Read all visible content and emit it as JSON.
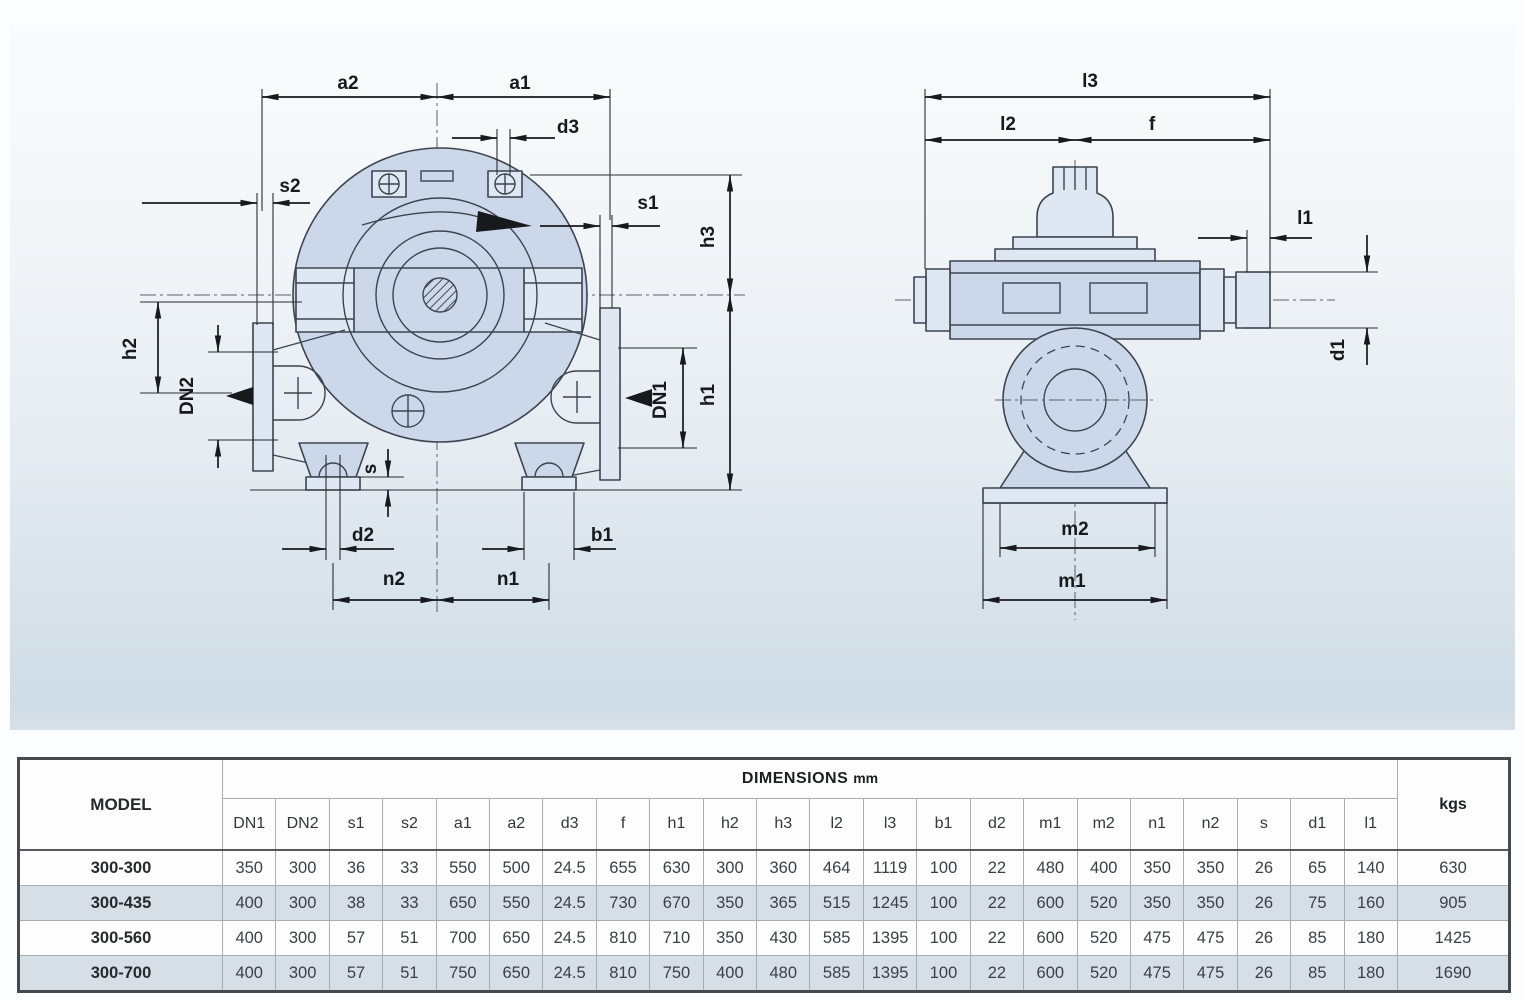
{
  "drawing": {
    "front_labels": {
      "a2": "a2",
      "a1": "a1",
      "d3": "d3",
      "s2": "s2",
      "s1": "s1",
      "h3": "h3",
      "h2": "h2",
      "h1": "h1",
      "dn2": "DN2",
      "dn1": "DN1",
      "s": "s",
      "d2": "d2",
      "b1": "b1",
      "n2": "n2",
      "n1": "n1"
    },
    "side_labels": {
      "l3": "l3",
      "l2": "l2",
      "f": "f",
      "l1": "l1",
      "d1": "d1",
      "m2": "m2",
      "m1": "m1"
    }
  },
  "table": {
    "model_header": "MODEL",
    "dimensions_header": "DIMENSIONS",
    "dimensions_unit": "mm",
    "weight_header": "kgs",
    "columns": [
      "DN1",
      "DN2",
      "s1",
      "s2",
      "a1",
      "a2",
      "d3",
      "f",
      "h1",
      "h2",
      "h3",
      "l2",
      "l3",
      "b1",
      "d2",
      "m1",
      "m2",
      "n1",
      "n2",
      "s",
      "d1",
      "l1"
    ],
    "rows": [
      {
        "model": "300-300",
        "values": [
          "350",
          "300",
          "36",
          "33",
          "550",
          "500",
          "24.5",
          "655",
          "630",
          "300",
          "360",
          "464",
          "1119",
          "100",
          "22",
          "480",
          "400",
          "350",
          "350",
          "26",
          "65",
          "140"
        ],
        "weight": "630"
      },
      {
        "model": "300-435",
        "values": [
          "400",
          "300",
          "38",
          "33",
          "650",
          "550",
          "24.5",
          "730",
          "670",
          "350",
          "365",
          "515",
          "1245",
          "100",
          "22",
          "600",
          "520",
          "350",
          "350",
          "26",
          "75",
          "160"
        ],
        "weight": "905"
      },
      {
        "model": "300-560",
        "values": [
          "400",
          "300",
          "57",
          "51",
          "700",
          "650",
          "24.5",
          "810",
          "710",
          "350",
          "430",
          "585",
          "1395",
          "100",
          "22",
          "600",
          "520",
          "475",
          "475",
          "26",
          "85",
          "180"
        ],
        "weight": "1425"
      },
      {
        "model": "300-700",
        "values": [
          "400",
          "300",
          "57",
          "51",
          "750",
          "650",
          "24.5",
          "810",
          "750",
          "400",
          "480",
          "585",
          "1395",
          "100",
          "22",
          "600",
          "520",
          "475",
          "475",
          "26",
          "85",
          "180"
        ],
        "weight": "1690"
      }
    ]
  },
  "colors": {
    "panel_top": "#fafbfc",
    "panel_bottom": "#cfdce6",
    "pump_body": "#ccd8e9",
    "outline": "#3c4450",
    "dim_line": "#17191d",
    "stripe_row": "#d6dfe6",
    "table_border": "#46494d"
  }
}
